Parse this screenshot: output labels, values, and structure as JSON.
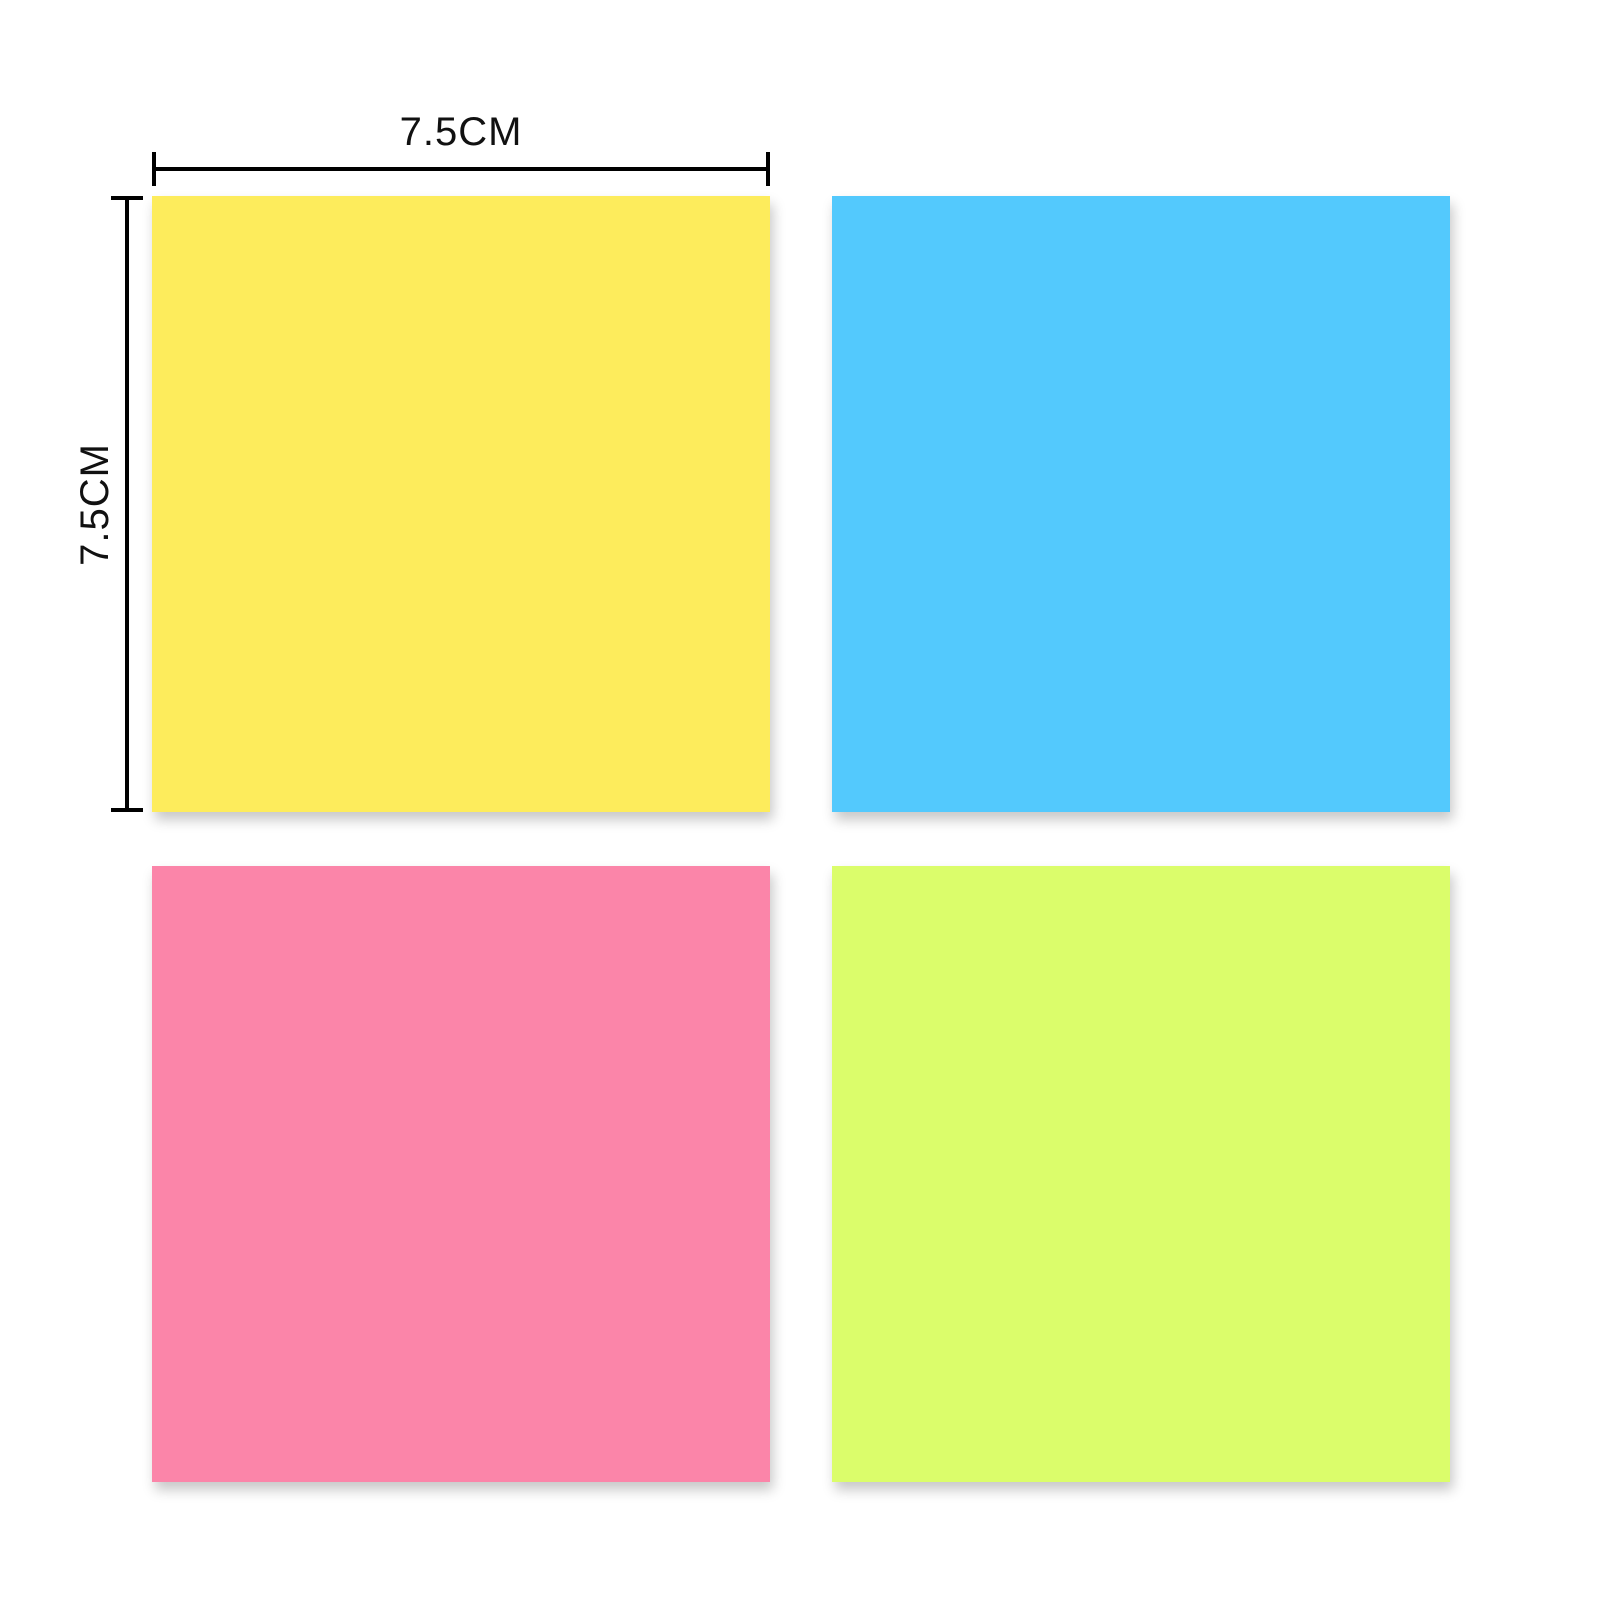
{
  "canvas": {
    "background_color": "#ffffff"
  },
  "dimension_annotations": {
    "width": {
      "label": "7.5CM"
    },
    "height": {
      "label": "7.5CM"
    },
    "line_color": "#000000",
    "label_color": "#111111"
  },
  "sticky_notes": [
    {
      "id": "yellow",
      "color": "#FDEC5C"
    },
    {
      "id": "blue",
      "color": "#53C9FD"
    },
    {
      "id": "pink",
      "color": "#FB85A9"
    },
    {
      "id": "green",
      "color": "#DBFD6B"
    }
  ]
}
